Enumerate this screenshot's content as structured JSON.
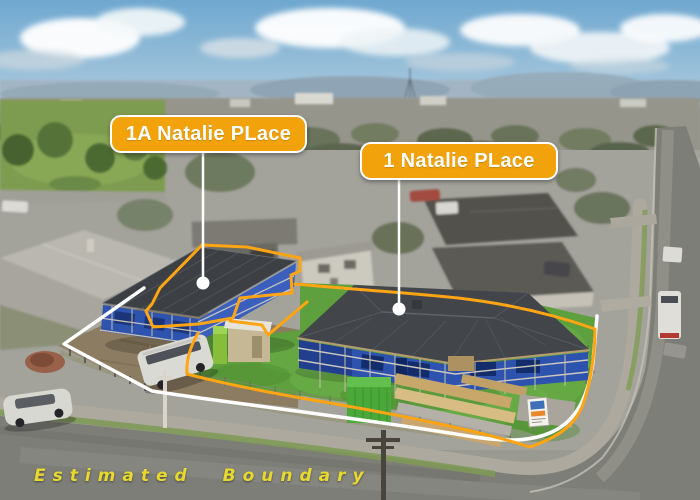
{
  "callouts": [
    {
      "label": "1A Natalie PLace"
    },
    {
      "label": "1 Natalie PLace"
    }
  ],
  "boundary_note": "Estimated Boundary",
  "colors": {
    "callout_bg": "#F2A30B",
    "callout_text": "#FFFFFF",
    "callout_border": "#FFFFFF",
    "boundary_orange": "#FFA413",
    "boundary_white": "#FFFFFF",
    "boundary_text": "#E8D92F"
  }
}
